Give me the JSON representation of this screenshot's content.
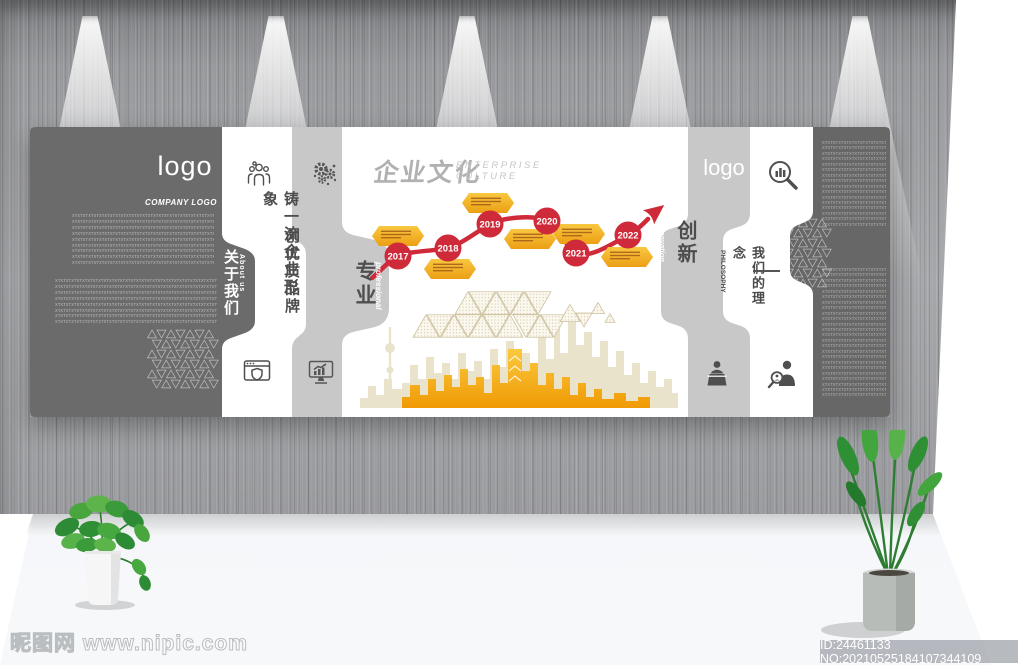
{
  "panel": {
    "left": {
      "logo": "logo",
      "company_logo": "COMPANY LOGO",
      "about_cn": "关于我们",
      "about_en": "About us",
      "placeholder_pattern": "XTXTXTXTXTXTXTXTXTXTXTXTXTXTXTXTXTXTXTXTXTXTXTXTXTXTXTXTXTXTXTXTXTXTXTXTXTXTXTXT",
      "block1_rows": 9,
      "block2_rows": 8
    },
    "bands": {
      "slogan1": "铸一流企业形象",
      "slogan2": "创优质品牌",
      "professional_cn": "专业",
      "professional_en": "professional",
      "innovation_cn": "创新",
      "innovation_en": "Innovation",
      "philosophy_cn": "我们的理念",
      "philosophy_en": "PHILOSOPHY",
      "logo2": "logo"
    },
    "title": {
      "cn": "企业文化",
      "en": "ENTERPRISE\nCULTURE"
    },
    "timeline": {
      "years": [
        "2017",
        "2018",
        "2019",
        "2020",
        "2021",
        "2022"
      ]
    },
    "right_panel": {
      "block1_rows": 16,
      "block2_rows": 24
    }
  },
  "icons": {
    "left_band_top": "team-icon",
    "gray_band_top": "gears-icon",
    "left_band_bottom": "browser-shield-icon",
    "gray_band_bottom": "monitor-chart-icon",
    "right_band_top": "magnifier-chart-icon",
    "right_gray_bottom": "podium-speaker-icon",
    "right_band_bottom": "person-search-icon"
  },
  "colors": {
    "timeline_red": "#cf2a39",
    "tag_gold": "#f2b01e",
    "dark_panel": "#6b6b6b",
    "light_band": "#c8c8c8",
    "skyline_back": "#eae3cb",
    "skyline_front": "#f6a913"
  },
  "watermarks": {
    "site": "昵图网 www.nipic.com",
    "id_label": "ID:24461133 NO:20210525184107344109"
  }
}
